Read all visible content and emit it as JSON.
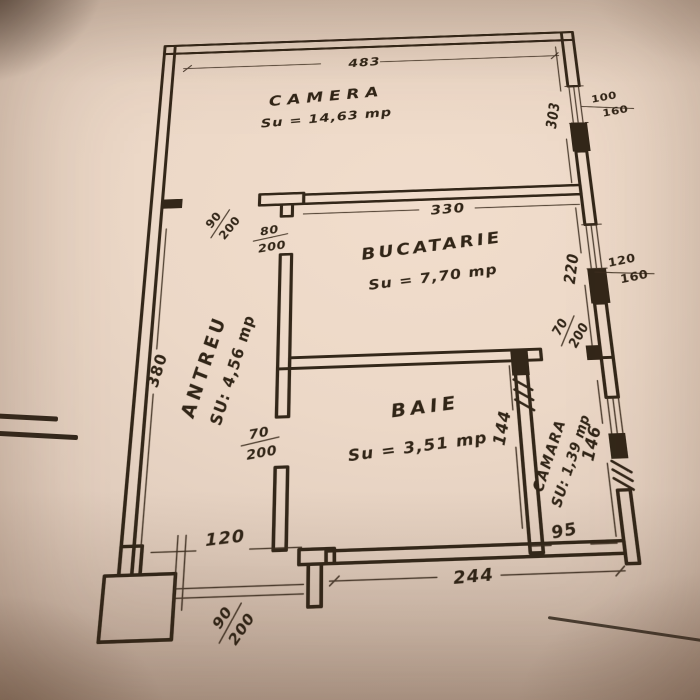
{
  "plan": {
    "rooms": [
      {
        "name": "CAMERA",
        "area": "Su = 14,63 mp"
      },
      {
        "name": "BUCATARIE",
        "area": "Su = 7,70 mp"
      },
      {
        "name": "ANTREU",
        "area": "SU: 4,56 mp"
      },
      {
        "name": "BAIE",
        "area": "Su = 3,51 mp"
      },
      {
        "name": "CAMARA",
        "area": "SU: 1,39 mp"
      }
    ],
    "dims": {
      "camera_width": "483",
      "camera_depth": "303",
      "kitchen_width": "330",
      "kitchen_depth": "220",
      "antreu_depth": "380",
      "baie_depth": "144",
      "baie_width": "244",
      "antreu_width": "120",
      "camara_width": "95",
      "camara_depth": "146"
    },
    "doors": {
      "camera": {
        "w": "90",
        "h": "200"
      },
      "kitchen": {
        "w": "80",
        "h": "200"
      },
      "baie": {
        "w": "70",
        "h": "200"
      },
      "camara": {
        "w": "70",
        "h": "200"
      },
      "entry": {
        "w": "90",
        "h": "200"
      }
    },
    "windows": {
      "camera": {
        "w": "100",
        "h": "160"
      },
      "kitchen": {
        "w": "120",
        "h": "160"
      }
    },
    "colors": {
      "ink": "#332719",
      "paper": "#ecd8c7"
    }
  }
}
